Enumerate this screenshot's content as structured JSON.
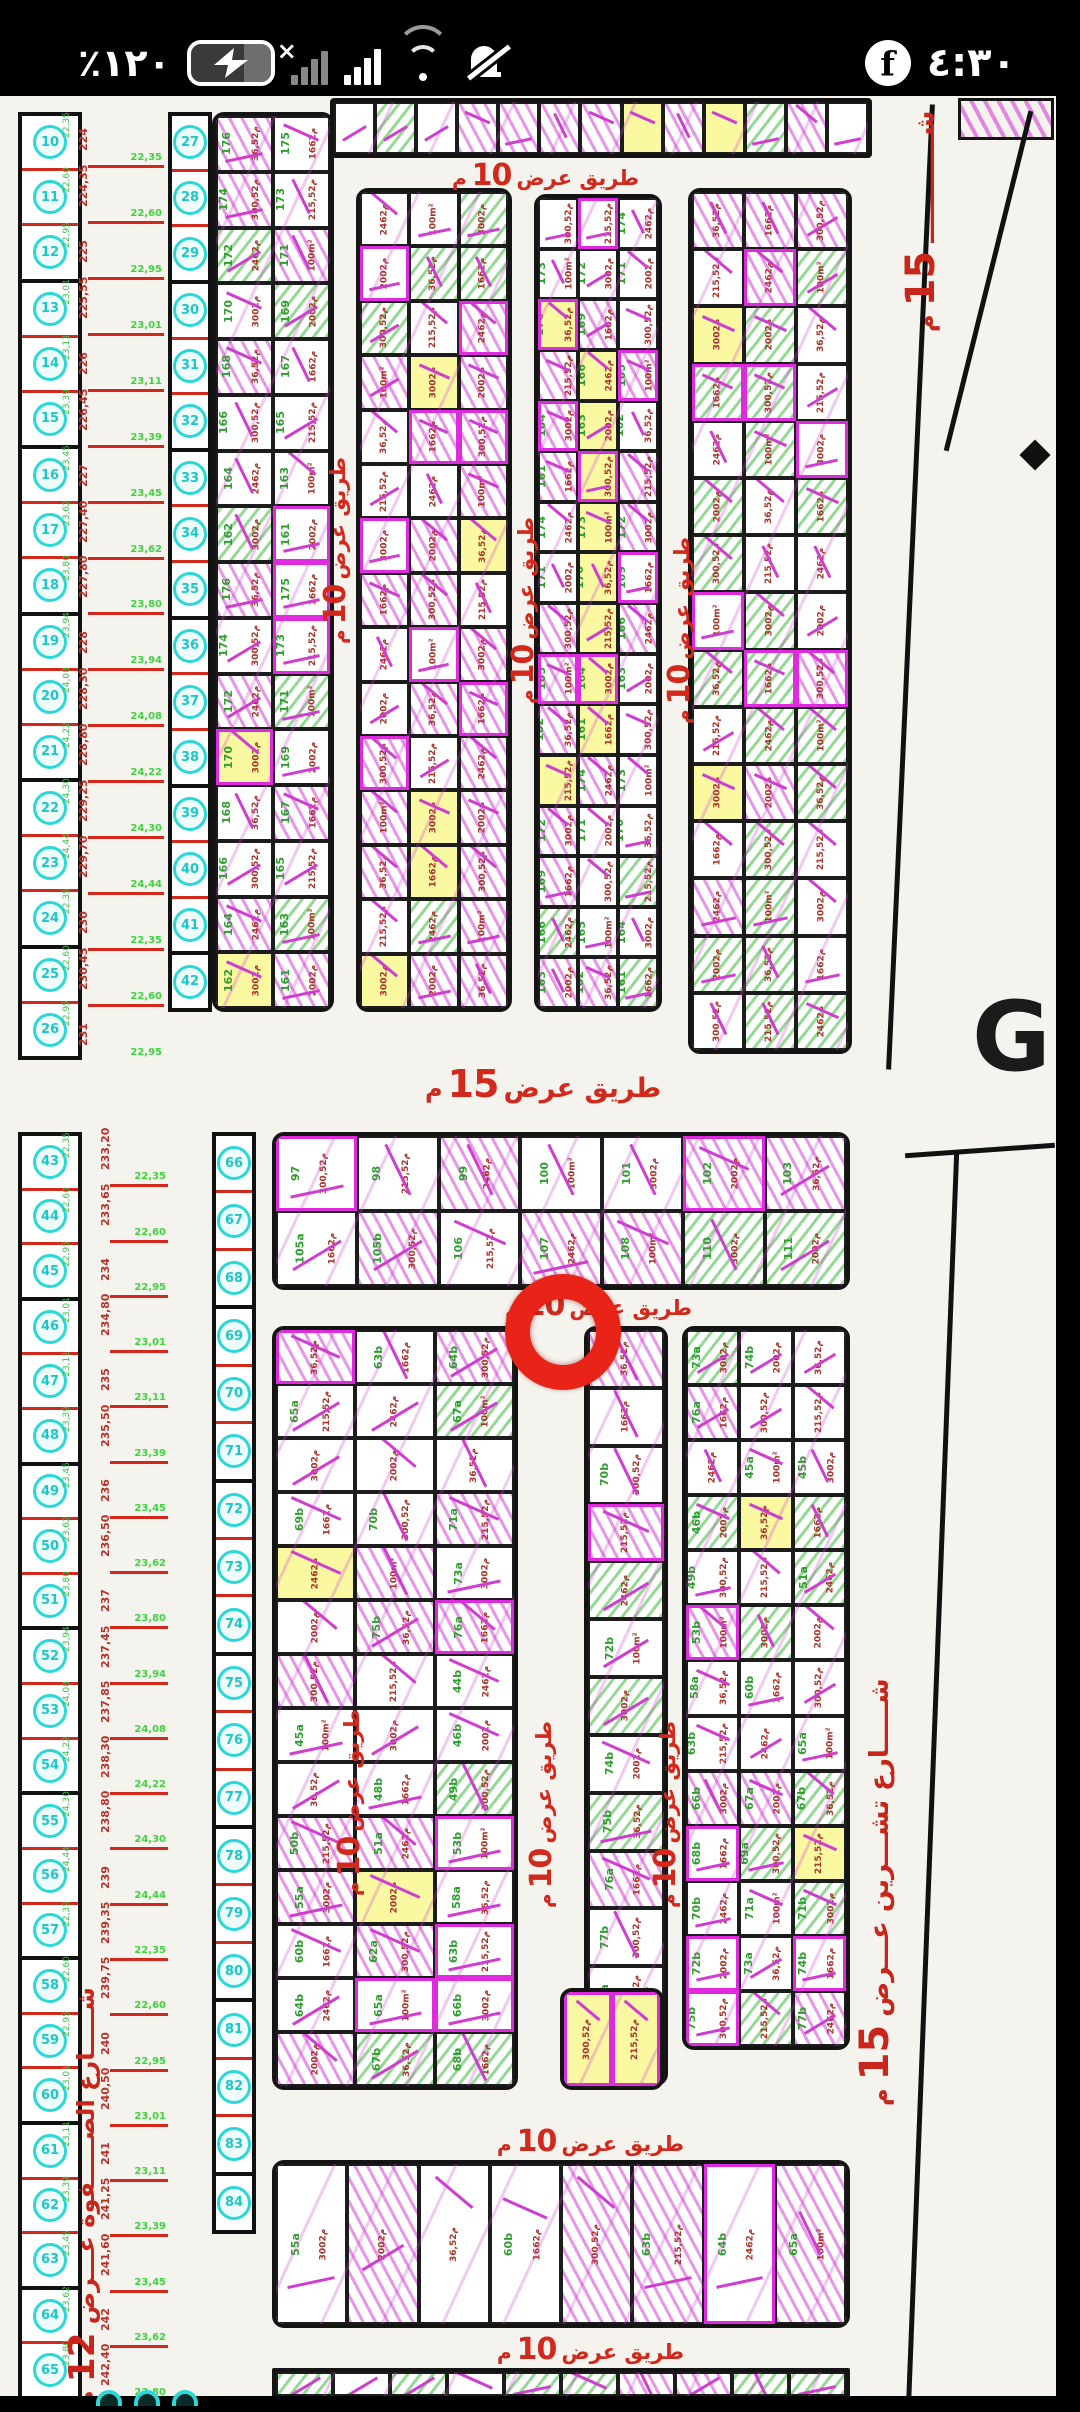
{
  "status_bar": {
    "battery_percent": "٪١٢٠",
    "time": "٤:٣٠",
    "icons": [
      "battery-charging-icon",
      "no-sim-signal-icon",
      "signal-bars-icon",
      "wifi-icon",
      "alarm-muted-icon",
      "facebook-icon"
    ]
  },
  "map": {
    "road10": {
      "unit": "م",
      "number": "10",
      "name": "طريق عرض"
    },
    "road15": {
      "unit": "م",
      "number": "15",
      "name": "طريق عرض"
    },
    "streets": {
      "right": {
        "unit": "م",
        "number": "15",
        "name": "شـــــارع تشـــرين عـــرض"
      },
      "left": {
        "unit": "م",
        "number": "12",
        "name": "شـــــارع الصـــــفوة عـــرض"
      },
      "right_top": {
        "unit": "م",
        "number": "15",
        "name": "شــــــــــــ"
      }
    },
    "marker_color": "#e82318",
    "watermark": "G",
    "survey_numbers_upper": [
      "224",
      "224,35",
      "225",
      "225,55",
      "226",
      "226,45",
      "227",
      "227,40",
      "227,80",
      "228",
      "228,30",
      "228,80",
      "229,25",
      "229,70",
      "230",
      "230,45",
      "231",
      "231,55",
      "232"
    ],
    "survey_numbers_lower": [
      "233,20",
      "233,65",
      "234",
      "234,80",
      "235",
      "235,50",
      "236",
      "236,50",
      "237",
      "237,45",
      "237,85",
      "238,30",
      "238,80",
      "239",
      "239,35",
      "239,75",
      "240",
      "240,50",
      "241",
      "241,25",
      "241,60",
      "242",
      "242,40",
      "242,80",
      "243",
      "243,50",
      "244"
    ],
    "green_numbers": [
      "22,35",
      "22,60",
      "22,95",
      "23,01",
      "23,11",
      "23,39",
      "23,45",
      "23,62",
      "23,80",
      "23,94",
      "24,08",
      "24,22",
      "24,30",
      "24,44"
    ],
    "circle_numbers_upper": [
      "10",
      "11",
      "12",
      "13",
      "14",
      "15",
      "16",
      "17",
      "18",
      "19",
      "20",
      "21",
      "22",
      "23",
      "24",
      "25",
      "26"
    ],
    "circle_numbers_col2_upper": [
      "27",
      "28",
      "29",
      "30",
      "31",
      "32",
      "33",
      "34",
      "35",
      "36",
      "37",
      "38",
      "39",
      "40",
      "41",
      "42"
    ],
    "circle_numbers_lower": [
      "43",
      "44",
      "45",
      "46",
      "47",
      "48",
      "49",
      "50",
      "51",
      "52",
      "53",
      "54",
      "55",
      "56",
      "57",
      "58",
      "59",
      "60",
      "61",
      "62",
      "63",
      "64",
      "65"
    ],
    "circle_numbers_col2_lower": [
      "66",
      "67",
      "68",
      "69",
      "70",
      "71",
      "72",
      "73",
      "74",
      "75",
      "76",
      "77",
      "78",
      "79",
      "80",
      "81",
      "82",
      "83",
      "84"
    ],
    "col2_numbers": [
      "176",
      "175",
      "174",
      "173",
      "172",
      "171",
      "170",
      "169",
      "168",
      "167",
      "166",
      "165",
      "164",
      "163",
      "162",
      "161"
    ],
    "block_numbers": [
      "97",
      "98",
      "99",
      "100",
      "101",
      "102",
      "103",
      "105a",
      "105b",
      "106",
      "107",
      "108",
      "110",
      "111"
    ],
    "plot_codes": [
      "44a",
      "44b",
      "45a",
      "45b",
      "46b",
      "47a",
      "48b",
      "49b",
      "50b",
      "51a",
      "53b",
      "55a",
      "57b",
      "58a",
      "60b",
      "62a",
      "63b",
      "64b",
      "65a",
      "66b",
      "67a",
      "67b",
      "68b",
      "69a",
      "69b",
      "70b",
      "71a",
      "71b",
      "72b",
      "73a",
      "74b",
      "75b",
      "76a",
      "77b"
    ],
    "area_labels": [
      "100m²",
      "300م2",
      "200م2",
      "36,5م2",
      "166م2",
      "300,5م2",
      "215,5م2",
      "246م2"
    ],
    "stroke_mark": "ـــــ"
  }
}
